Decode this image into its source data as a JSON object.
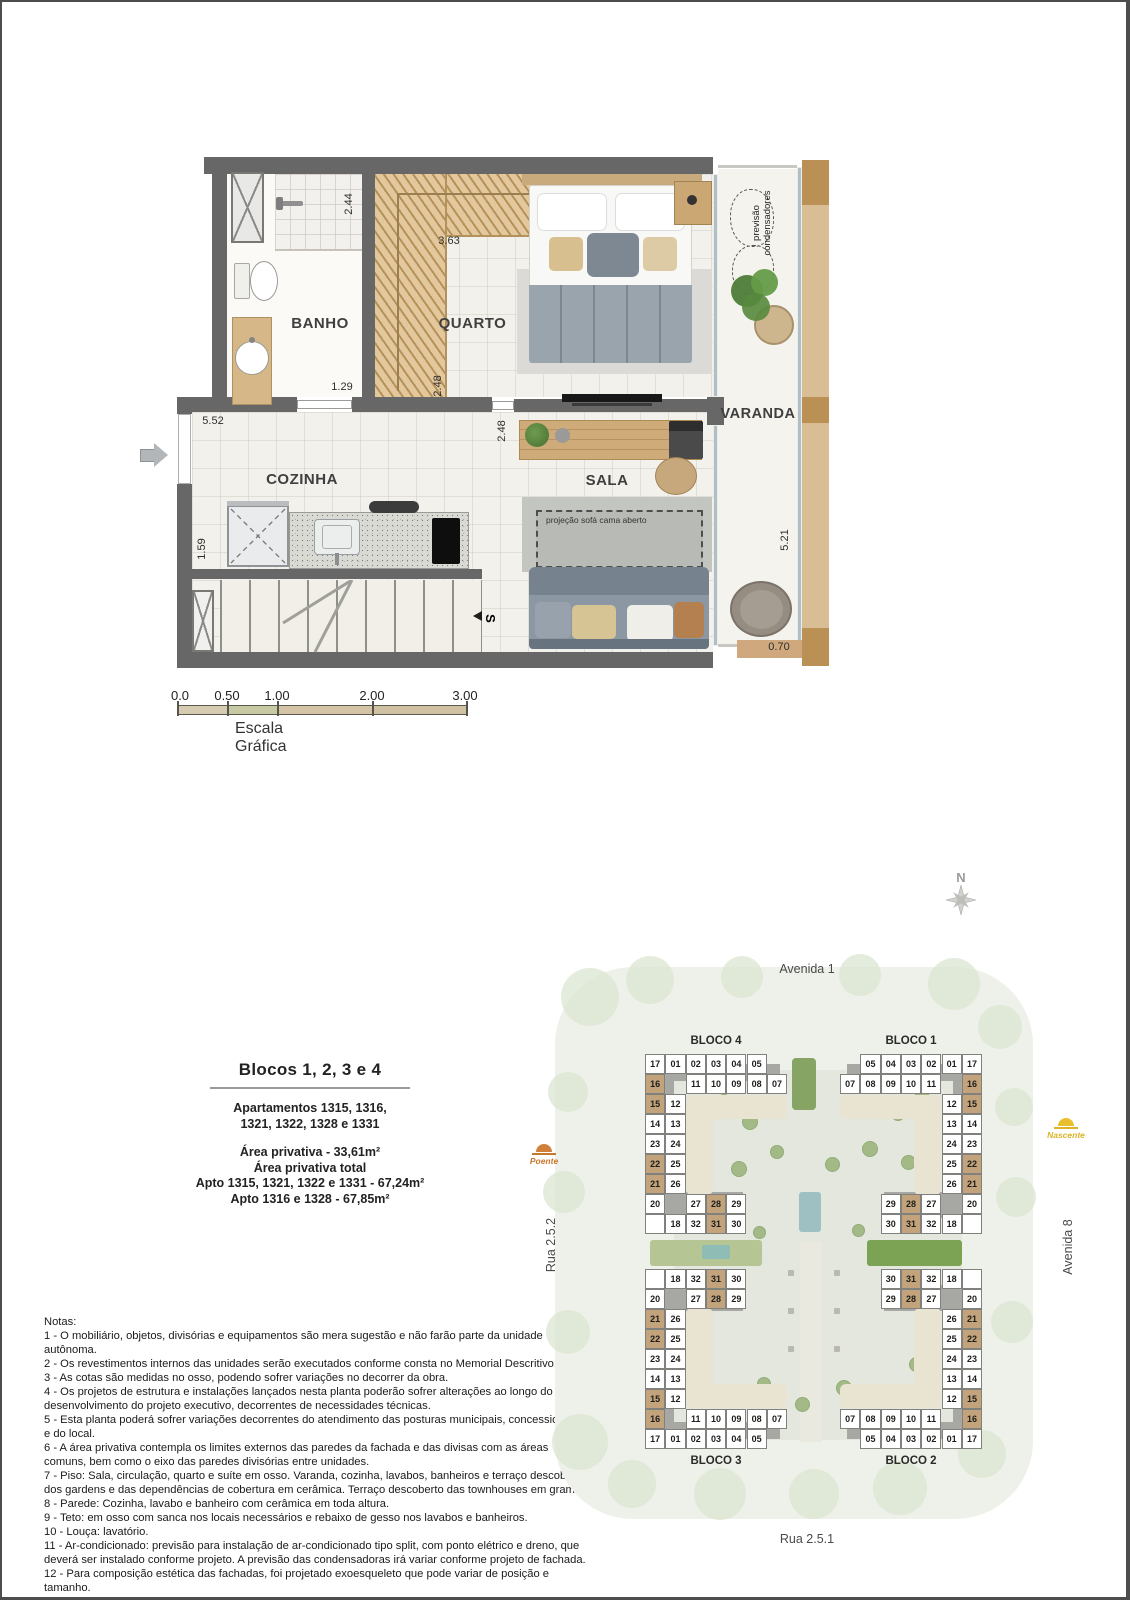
{
  "floor_plan": {
    "rooms": {
      "banho": "BANHO",
      "quarto": "QUARTO",
      "cozinha": "COZINHA",
      "sala": "SALA",
      "varanda": "VARANDA"
    },
    "dims": {
      "d244": "2.44",
      "d363": "3.63",
      "d129": "1.29",
      "d248a": "2.48",
      "d248b": "2.48",
      "d552": "5.52",
      "d159": "1.59",
      "d521": "5.21",
      "d070": "0.70"
    },
    "annotations": {
      "condensers_line1": "previsão",
      "condensers_line2": "condensadores",
      "sofa_projection": "projeção sofá cama aberto",
      "stairs_marker": "S"
    }
  },
  "scale_bar": {
    "ticks": [
      "0.0",
      "0.50",
      "1.00",
      "2.00",
      "3.00"
    ],
    "caption": "Escala Gráfica"
  },
  "info": {
    "title": "Blocos 1, 2, 3 e 4",
    "lines": [
      "Apartamentos 1315, 1316,",
      "1321, 1322, 1328 e 1331",
      "Área privativa - 33,61m²",
      "Área privativa total",
      "Apto 1315, 1321, 1322 e 1331 - 67,24m²",
      "Apto 1316 e 1328 - 67,85m²"
    ]
  },
  "notes": {
    "title": "Notas:",
    "items": [
      "1 - O mobiliário, objetos, divisórias e equipamentos são mera sugestão e não farão parte da unidade autônoma.",
      "2 - Os revestimentos internos das unidades serão executados conforme consta no Memorial Descritivo.",
      "3 - As cotas são medidas no osso, podendo sofrer variações no decorrer da obra.",
      "4 - Os projetos de estrutura e instalações lançados nesta planta poderão sofrer alterações ao longo do desenvolvimento do projeto executivo, decorrentes de necessidades técnicas.",
      "5 - Esta planta poderá sofrer variações decorrentes do atendimento das posturas municipais, concessionárias e do local.",
      "6 - A área privativa contempla os limites externos das paredes da fachada e das divisas com as áreas comuns, bem como o eixo das paredes divisórias entre unidades.",
      "7 - Piso: Sala, circulação, quarto e suíte em osso. Varanda, cozinha, lavabos, banheiros e terraço descoberto dos gardens e das dependências de cobertura em cerâmica. Terraço descoberto das townhouses em grama.",
      "8 - Parede: Cozinha, lavabo e banheiro com cerâmica em toda altura.",
      "9 - Teto: em osso com sanca nos locais necessários e rebaixo de gesso nos lavabos e banheiros.",
      "10 - Louça: lavatório.",
      "11 - Ar-condicionado: previsão para instalação de ar-condicionado tipo split, com ponto elétrico e dreno, que deverá ser instalado conforme projeto. A previsão das condensadoras irá variar conforme projeto de fachada.",
      "12 - Para composição estética das fachadas, foi projetado exoesqueleto que pode variar de posição e tamanho.",
      "13 - Será entregue previsão para instalação de máquina de lavar roupas (MLR), com ponto elétrico, hidráulica e esgoto.",
      "14 - A unidade será entregue com ponto para instalação de cooktop elétrico, não havendo viabilidade para instalação de gás."
    ]
  },
  "site_plan": {
    "streets": {
      "top": "Avenida 1",
      "bottom": "Rua 2.5.1",
      "left": "Rua 2.5.2",
      "right": "Avenida 8"
    },
    "compass_label": "N",
    "sun_west": "Poente",
    "sun_east": "Nascente",
    "blocos": [
      {
        "label": "BLOCO 4",
        "mirror_x": false,
        "mirror_y": false
      },
      {
        "label": "BLOCO 1",
        "mirror_x": true,
        "mirror_y": false
      },
      {
        "label": "BLOCO 3",
        "mirror_x": false,
        "mirror_y": true
      },
      {
        "label": "BLOCO 2",
        "mirror_x": true,
        "mirror_y": true
      }
    ],
    "base_cells": [
      {
        "n": "17",
        "c": 0,
        "r": 0
      },
      {
        "n": "01",
        "c": 1,
        "r": 0
      },
      {
        "n": "02",
        "c": 2,
        "r": 0
      },
      {
        "n": "03",
        "c": 3,
        "r": 0
      },
      {
        "n": "04",
        "c": 4,
        "r": 0
      },
      {
        "n": "05",
        "c": 5,
        "r": 0
      },
      {
        "n": "16",
        "c": 0,
        "r": 1
      },
      {
        "n": "11",
        "c": 2,
        "r": 1
      },
      {
        "n": "10",
        "c": 3,
        "r": 1
      },
      {
        "n": "09",
        "c": 4,
        "r": 1
      },
      {
        "n": "08",
        "c": 5,
        "r": 1
      },
      {
        "n": "07",
        "c": 6,
        "r": 1
      },
      {
        "n": "15",
        "c": 0,
        "r": 2
      },
      {
        "n": "12",
        "c": 1,
        "r": 2
      },
      {
        "n": "14",
        "c": 0,
        "r": 3
      },
      {
        "n": "13",
        "c": 1,
        "r": 3
      },
      {
        "n": "23",
        "c": 0,
        "r": 4
      },
      {
        "n": "24",
        "c": 1,
        "r": 4
      },
      {
        "n": "22",
        "c": 0,
        "r": 5
      },
      {
        "n": "25",
        "c": 1,
        "r": 5
      },
      {
        "n": "21",
        "c": 0,
        "r": 6
      },
      {
        "n": "26",
        "c": 1,
        "r": 6
      },
      {
        "n": "20",
        "c": 0,
        "r": 7
      },
      {
        "n": "27",
        "c": 2,
        "r": 7
      },
      {
        "n": "28",
        "c": 3,
        "r": 7
      },
      {
        "n": "29",
        "c": 4,
        "r": 7
      },
      {
        "n": "X",
        "c": 0,
        "r": 8
      },
      {
        "n": "18",
        "c": 1,
        "r": 8
      },
      {
        "n": "32",
        "c": 2,
        "r": 8
      },
      {
        "n": "31",
        "c": 3,
        "r": 8
      },
      {
        "n": "30",
        "c": 4,
        "r": 8
      }
    ],
    "highlighted_units": [
      "15",
      "16",
      "21",
      "22",
      "28",
      "31"
    ]
  },
  "colors": {
    "highlight": "#c2a37c",
    "wall": "#676767",
    "sun_west": "#c9762c",
    "sun_east": "#d9b32a"
  }
}
